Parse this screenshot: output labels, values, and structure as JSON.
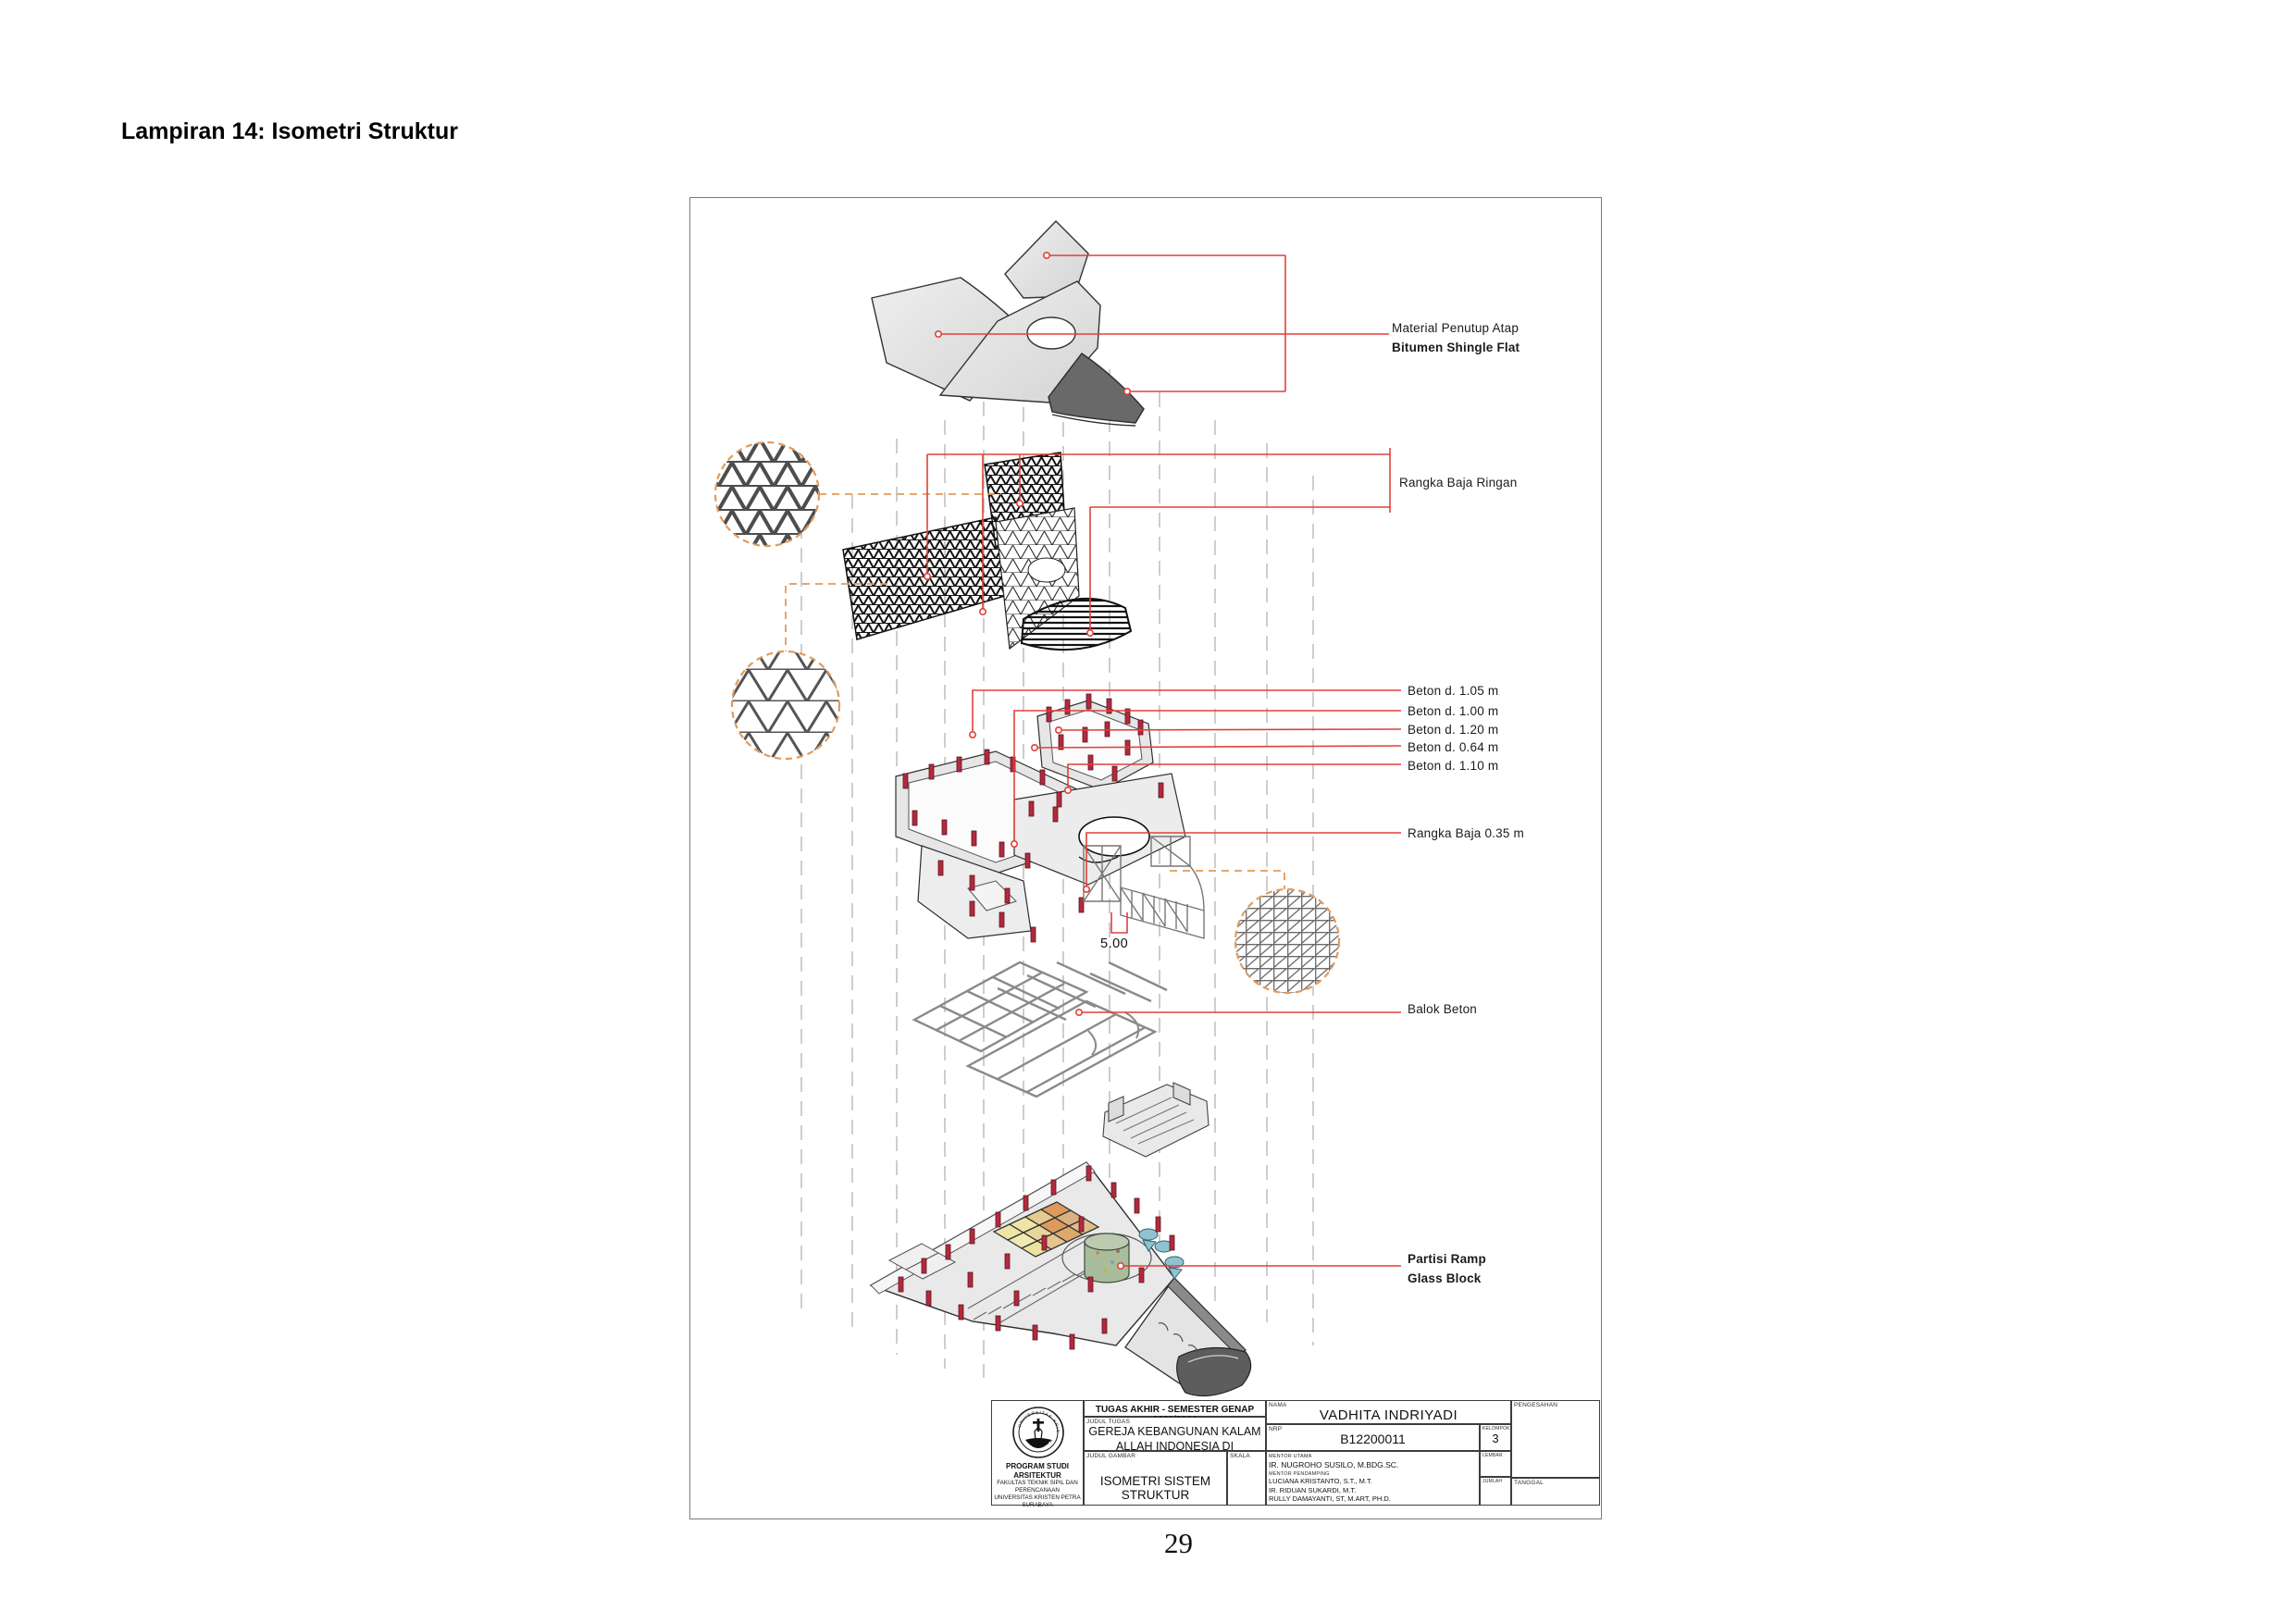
{
  "page": {
    "heading": "Lampiran 14: Isometri Struktur",
    "page_number": "29"
  },
  "drawing": {
    "labels": {
      "roof_material_line1": "Material Penutup Atap",
      "roof_material_line2": "Bitumen Shingle Flat",
      "light_steel_truss": "Rangka Baja Ringan",
      "beton_items": [
        "Beton d. 1.05 m",
        "Beton d. 1.00 m",
        "Beton d. 1.20 m",
        "Beton d. 0.64 m",
        "Beton d. 1.10 m"
      ],
      "steel_frame": "Rangka Baja 0.35 m",
      "concrete_beam": "Balok Beton",
      "partition_line1": "Partisi Ramp",
      "partition_line2": "Glass Block",
      "dimension": "5.00"
    },
    "colors": {
      "leader_red": "#E0413B",
      "column_red": "#B12A3C",
      "detail_circle_orange": "#E39A5B",
      "roof_panel_light": "#E4E4E4",
      "roof_panel_dark": "#696969"
    }
  },
  "titleblock": {
    "header": "TUGAS AKHIR - SEMESTER GENAP 2023/2024",
    "judul_tugas_label": "JUDUL TUGAS",
    "judul_tugas_line1": "GEREJA KEBANGUNAN KALAM",
    "judul_tugas_line2": "ALLAH INDONESIA DI SURABAYA",
    "judul_gambar_label": "JUDUL GAMBAR",
    "judul_gambar": "ISOMETRI SISTEM STRUKTUR",
    "skala_label": "SKALA",
    "nama_label": "NAMA",
    "nama": "VADHITA INDRIYADI",
    "nrp_label": "NRP",
    "nrp": "B12200011",
    "kelompok_label": "KELOMPOK",
    "kelompok": "3",
    "mentor_utama_label": "MENTOR UTAMA",
    "mentor_utama": "IR. NUGROHO SUSILO, M.BDG.SC.",
    "mentor_pendamping_label": "MENTOR PENDAMPING",
    "mentor_pendamping": [
      "LUCIANA KRISTANTO, S.T., M.T.",
      "IR. RIDUAN SUKARDI, M.T.",
      "RULLY DAMAYANTI, ST, M.ART, PH.D."
    ],
    "lembar_label": "LEMBAR",
    "jumlah_label": "JUMLAH",
    "tanggal_label": "TANGGAL",
    "pengesahan_label": "PENGESAHAN",
    "logo_ring_top": "UNIVERSITAS KRISTEN",
    "logo_ring_bottom": "PETRA",
    "program_lines": [
      "PROGRAM STUDI ARSITEKTUR",
      "FAKULTAS TEKNIK SIPIL DAN PERENCANAAN",
      "UNIVERSITAS KRISTEN PETRA",
      "SURABAYA"
    ]
  }
}
